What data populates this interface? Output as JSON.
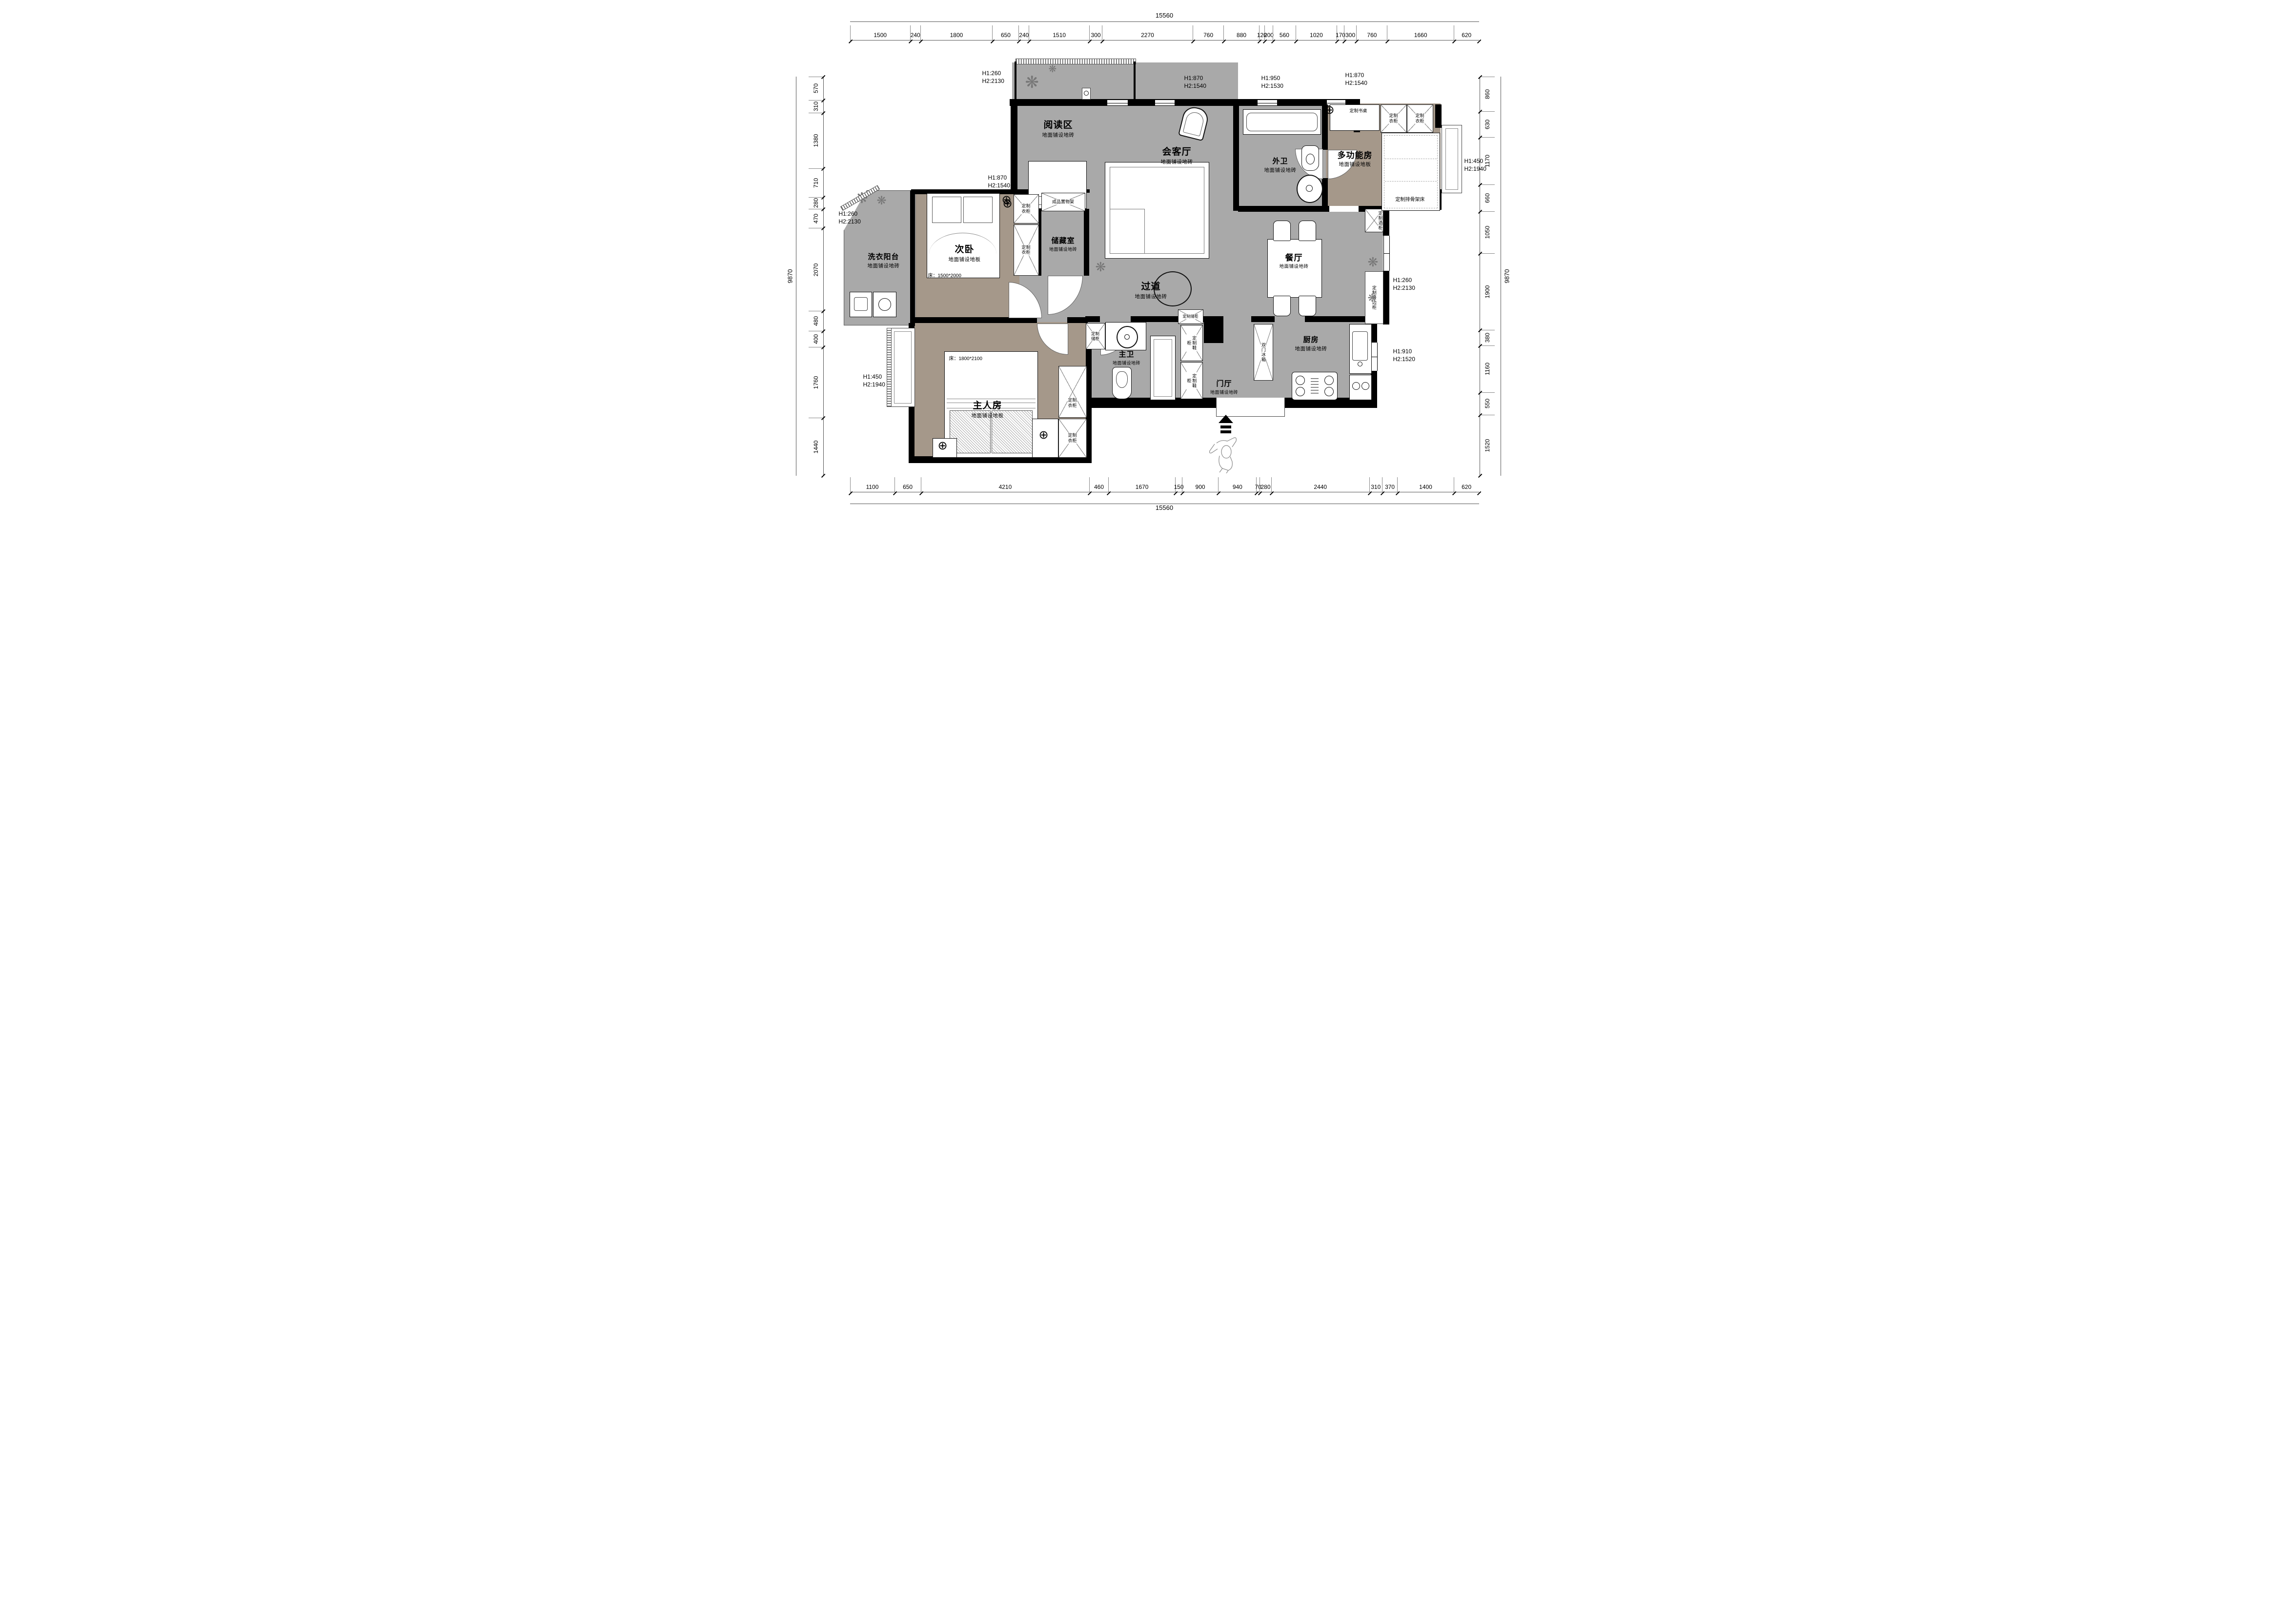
{
  "dimensions": {
    "top": {
      "total": "15560",
      "segments": [
        "1500",
        "240",
        "1800",
        "650",
        "240",
        "1510",
        "300",
        "2270",
        "760",
        "880",
        "120",
        "200",
        "560",
        "1020",
        "170",
        "300",
        "760",
        "1660",
        "620"
      ]
    },
    "bottom": {
      "total": "15560",
      "segments": [
        "1100",
        "650",
        "4210",
        "460",
        "1670",
        "150",
        "900",
        "940",
        "70",
        "280",
        "2440",
        "310",
        "370",
        "1400",
        "620"
      ]
    },
    "left": {
      "total": "9870",
      "segments": [
        "570",
        "310",
        "1380",
        "710",
        "280",
        "470",
        "2070",
        "480",
        "400",
        "1760",
        "1440"
      ]
    },
    "right": {
      "total": "9870",
      "segments": [
        "860",
        "630",
        "1170",
        "660",
        "1050",
        "1900",
        "380",
        "1160",
        "550",
        "1520"
      ]
    }
  },
  "rooms": [
    {
      "name": "阅读区",
      "floor": "地面铺设地砖"
    },
    {
      "name": "会客厅",
      "floor": "地面铺设地砖"
    },
    {
      "name": "外卫",
      "floor": "地面铺设地砖"
    },
    {
      "name": "多功能房",
      "floor": "地面铺设地板"
    },
    {
      "name": "洗衣阳台",
      "floor": "地面铺设地砖"
    },
    {
      "name": "次卧",
      "floor": "地面铺设地板"
    },
    {
      "name": "储藏室",
      "floor": "地面铺设地砖"
    },
    {
      "name": "过道",
      "floor": "地面铺设地砖"
    },
    {
      "name": "餐厅",
      "floor": "地面铺设地砖"
    },
    {
      "name": "主卫",
      "floor": "地面铺设地砖"
    },
    {
      "name": "门厅",
      "floor": "地面铺设地砖"
    },
    {
      "name": "厨房",
      "floor": "地面铺设地砖"
    },
    {
      "name": "主人房",
      "floor": "地面铺设地板"
    }
  ],
  "annotations": [
    {
      "l1": "H1:260",
      "l2": "H2:2130"
    },
    {
      "l1": "H1:870",
      "l2": "H2:1540"
    },
    {
      "l1": "H1:950",
      "l2": "H2:1530"
    },
    {
      "l1": "H1:870",
      "l2": "H2:1540"
    },
    {
      "l1": "H1:870",
      "l2": "H2:1540"
    },
    {
      "l1": "H1:260",
      "l2": "H2:2130"
    },
    {
      "l1": "H1:450",
      "l2": "H2:1940"
    },
    {
      "l1": "H1:260",
      "l2": "H2:2130"
    },
    {
      "l1": "H1:910",
      "l2": "H2:1520"
    },
    {
      "l1": "H1:450",
      "l2": "H2:1940"
    }
  ],
  "labels": {
    "desk": "定制书桌",
    "wardrobe": "定制衣柜",
    "shelf": "成品置物架",
    "slat_bed": "定制排骨架床",
    "wine_cabinet": "定制酒柜",
    "sideboard": "定制餐边柜",
    "storage_cabinet": "定制储柜",
    "shoe_cabinet": "定制鞋柜",
    "fridge": "双门冰箱",
    "bed_second": "床：1500*2000",
    "bed_master": "床：1800*2100"
  },
  "colors": {
    "wall": "#000000",
    "tile_floor": "#a9a9a9",
    "wood_floor": "#a5988a"
  }
}
